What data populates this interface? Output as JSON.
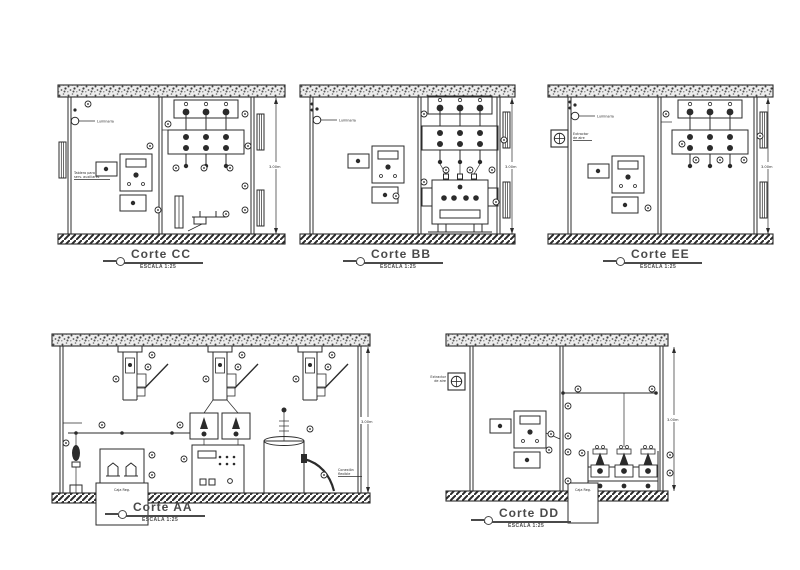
{
  "page": {
    "background": "#ffffff",
    "ink": "#2b2b2b",
    "title_color": "#4a4a4a"
  },
  "sections": [
    {
      "id": "CC",
      "title": "Corte CC",
      "scale": "ESCALA 1:25",
      "dimension": "3.00m",
      "labels": {
        "lamp": "Luminaria",
        "panel_line1": "Tablero para",
        "panel_line2": "serv. auxiliares"
      }
    },
    {
      "id": "BB",
      "title": "Corte BB",
      "scale": "ESCALA 1:25",
      "dimension": "3.00m",
      "labels": {
        "lamp": "Luminaria"
      }
    },
    {
      "id": "EE",
      "title": "Corte EE",
      "scale": "ESCALA 1:25",
      "dimension": "3.00m",
      "labels": {
        "lamp": "Luminaria",
        "extractor_line1": "Extractor",
        "extractor_line2": "de aire"
      }
    },
    {
      "id": "AA",
      "title": "Corte AA",
      "scale": "ESCALA 1:25",
      "dimension": "3.00m",
      "labels": {
        "pit": "Caja Reg.",
        "note_line1": "Conexión",
        "note_line2": "flexible"
      }
    },
    {
      "id": "DD",
      "title": "Corte DD",
      "scale": "ESCALA 1:25",
      "dimension": "3.00m",
      "labels": {
        "extractor_line1": "Extractor",
        "extractor_line2": "de aire",
        "pit": "Caja Reg."
      }
    }
  ]
}
